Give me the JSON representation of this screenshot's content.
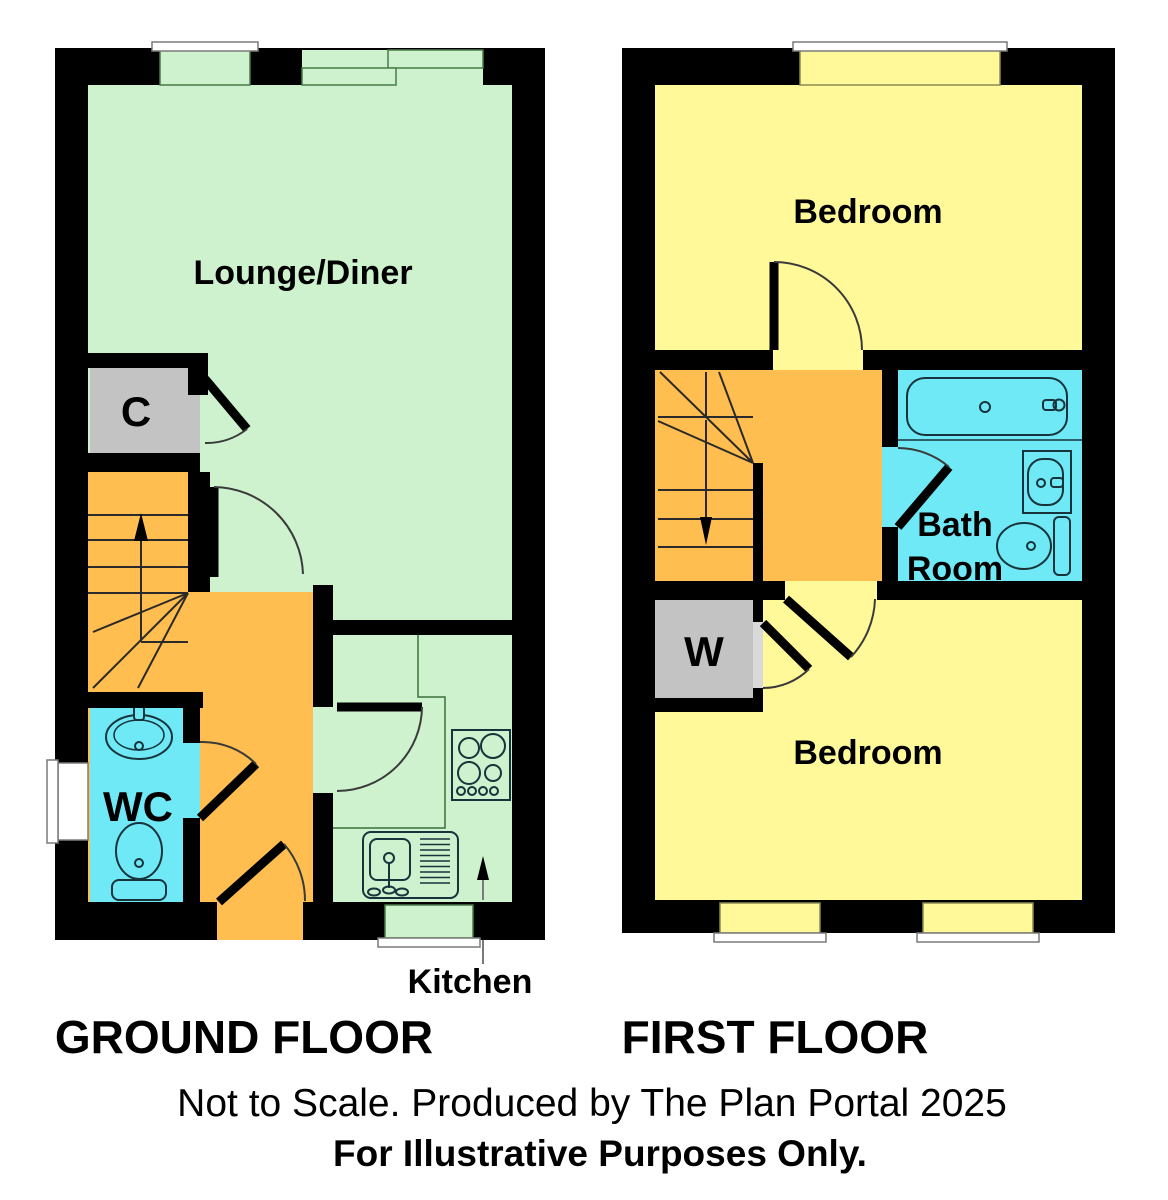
{
  "ground_floor": {
    "title": "GROUND FLOOR",
    "lounge": "Lounge/Diner",
    "closet": "C",
    "wc": "WC",
    "kitchen": "Kitchen"
  },
  "first_floor": {
    "title": "FIRST FLOOR",
    "bedroom_front": "Bedroom",
    "bath_line1": "Bath",
    "bath_line2": "Room",
    "wardrobe": "W",
    "bedroom_back": "Bedroom"
  },
  "footer": {
    "line1": "Not to Scale. Produced by The Plan Portal 2025",
    "line2": "For Illustrative Purposes Only."
  },
  "colors": {
    "room_green": "#cdf2cd",
    "room_yellow": "#fff999",
    "room_orange": "#ffbe4f",
    "room_cyan": "#70e9f7",
    "closet_gray": "#c3c3c3",
    "wall": "#000000"
  }
}
